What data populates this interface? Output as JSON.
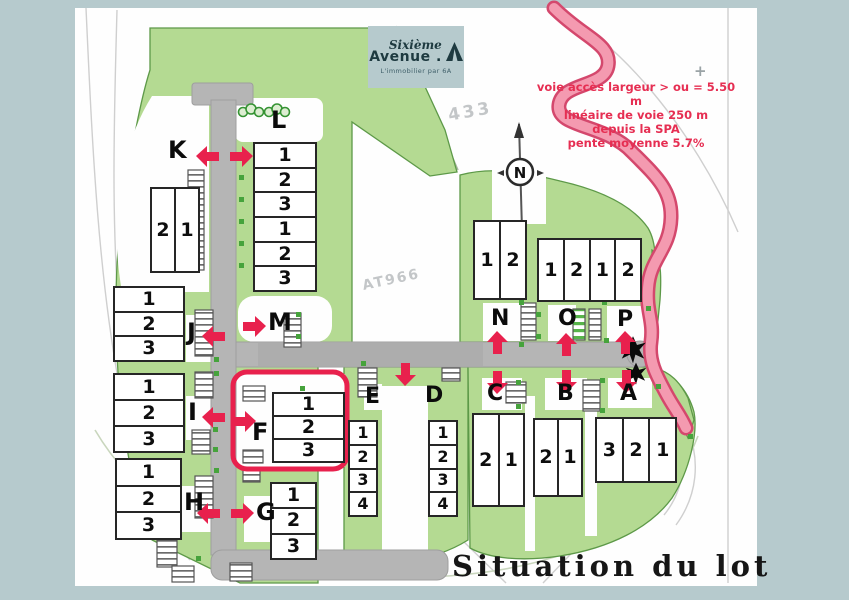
{
  "colors": {
    "background": "#b6cacd",
    "accent_red": "#e8214d",
    "site_green": "#b4da92",
    "road_gray": "#b5b5b5",
    "access_road_pink": "#f49ab0"
  },
  "logo": {
    "brand_top": "Sixième",
    "brand_bottom": "Avenue",
    "tagline": "L'immobilier par 6A"
  },
  "access_note": {
    "lines": [
      "voie accès largeur > ou = 5.50 m",
      "linéaire de voie 250 m",
      "depuis  la SPA",
      "pente moyenne 5.7%"
    ]
  },
  "map_labels": {
    "parcel_top": "433",
    "parcel_center": "AT966",
    "north": "N",
    "title": "Situation du lot",
    "plus_mark": "+"
  },
  "lots": {
    "K": {
      "letter": "K",
      "cells": [
        "2",
        "1"
      ]
    },
    "L": {
      "letter": "L",
      "cells": [
        "1",
        "2",
        "3",
        "1",
        "2",
        "3"
      ]
    },
    "M": {
      "letter": "M"
    },
    "J": {
      "letter": "J",
      "cells": [
        "1",
        "2",
        "3"
      ]
    },
    "I": {
      "letter": "I",
      "cells": [
        "1",
        "2",
        "3"
      ]
    },
    "H": {
      "letter": "H",
      "cells": [
        "1",
        "2",
        "3"
      ]
    },
    "G": {
      "letter": "G",
      "cells": [
        "1",
        "2",
        "3"
      ]
    },
    "F": {
      "letter": "F",
      "cells": [
        "1",
        "2",
        "3"
      ],
      "highlighted": true
    },
    "E": {
      "letter": "E",
      "cells": [
        "1",
        "2",
        "3",
        "4"
      ]
    },
    "D": {
      "letter": "D",
      "cells": [
        "1",
        "2",
        "3",
        "4"
      ]
    },
    "C": {
      "letter": "C",
      "cells": [
        "2",
        "1"
      ]
    },
    "B": {
      "letter": "B",
      "cells": [
        "2",
        "1"
      ]
    },
    "A": {
      "letter": "A",
      "cells": [
        "3",
        "2",
        "1"
      ]
    },
    "N": {
      "letter": "N",
      "cells": [
        "1",
        "2"
      ]
    },
    "O": {
      "letter": "O"
    },
    "P": {
      "letter": "P"
    },
    "OP": {
      "cells": [
        "1",
        "2",
        "1",
        "2"
      ]
    }
  }
}
